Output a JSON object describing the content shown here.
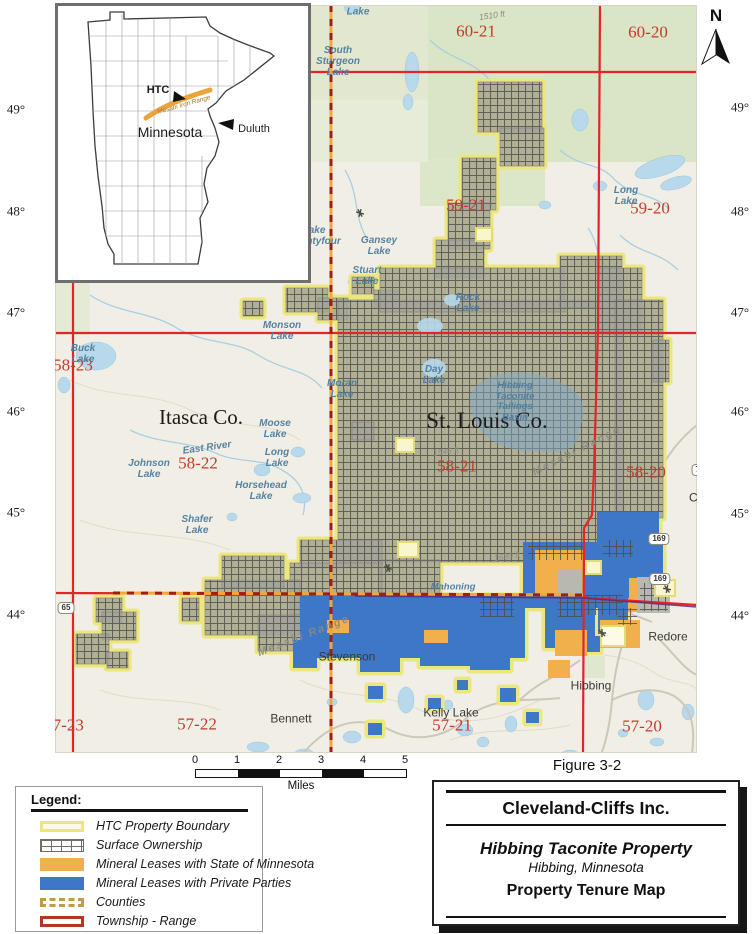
{
  "figure_label": "Figure 3-2",
  "title_block": {
    "company": "Cleveland-Cliffs Inc.",
    "property": "Hibbing Taconite Property",
    "location": "Hibbing, Minnesota",
    "map_title": "Property Tenure Map"
  },
  "legend": {
    "header": "Legend:",
    "items": [
      {
        "label": "HTC Property Boundary",
        "type": "boundary"
      },
      {
        "label": "Surface Ownership",
        "type": "surface"
      },
      {
        "label": "Mineral Leases with State of Minnesota",
        "type": "state-lease"
      },
      {
        "label": "Mineral Leases with Private Parties",
        "type": "private-lease"
      },
      {
        "label": "Counties",
        "type": "counties"
      },
      {
        "label": "Township - Range",
        "type": "township-range"
      }
    ]
  },
  "scale_bar": {
    "ticks": [
      "0",
      "1",
      "2",
      "3",
      "4",
      "5"
    ],
    "unit": "Miles"
  },
  "north_arrow": {
    "label": "N"
  },
  "inset": {
    "htc": "HTC",
    "range": "Mesabi Iron Range",
    "state": "Minnesota",
    "city": "Duluth"
  },
  "map": {
    "colors": {
      "property_boundary": "#ece67f",
      "surface_ownership": "#a3a29a",
      "state_lease": "#f0b14d",
      "private_lease": "#3d77c5",
      "township_line": "#e3242b",
      "county_line": "#f2a63a",
      "water": "#b7d9eb"
    },
    "townships": [
      {
        "text": "60-21",
        "x": 476,
        "y": 31
      },
      {
        "text": "60-20",
        "x": 648,
        "y": 32
      },
      {
        "text": "59-21",
        "x": 466,
        "y": 205
      },
      {
        "text": "59-20",
        "x": 650,
        "y": 208
      },
      {
        "text": "58-23",
        "x": 73,
        "y": 365
      },
      {
        "text": "58-22",
        "x": 198,
        "y": 463
      },
      {
        "text": "58-21",
        "x": 457,
        "y": 466
      },
      {
        "text": "58-20",
        "x": 646,
        "y": 472
      },
      {
        "text": "57-23",
        "x": 64,
        "y": 725
      },
      {
        "text": "57-22",
        "x": 197,
        "y": 724
      },
      {
        "text": "57-21",
        "x": 452,
        "y": 725
      },
      {
        "text": "57-20",
        "x": 642,
        "y": 726
      }
    ],
    "degrees_left": [
      {
        "text": "49°",
        "y": 110
      },
      {
        "text": "48°",
        "y": 212
      },
      {
        "text": "47°",
        "y": 313
      },
      {
        "text": "46°",
        "y": 412
      },
      {
        "text": "45°",
        "y": 513
      },
      {
        "text": "44°",
        "y": 615
      }
    ],
    "degrees_right": [
      {
        "text": "49°",
        "y": 108
      },
      {
        "text": "48°",
        "y": 212
      },
      {
        "text": "47°",
        "y": 313
      },
      {
        "text": "46°",
        "y": 412
      },
      {
        "text": "45°",
        "y": 514
      },
      {
        "text": "44°",
        "y": 616
      }
    ],
    "counties": [
      {
        "text": "Itasca Co.",
        "x": 201,
        "y": 418,
        "fs": 21
      },
      {
        "text": "St. Louis Co.",
        "x": 487,
        "y": 421,
        "fs": 23
      }
    ],
    "lakes": [
      {
        "text": "Lake",
        "x": 358,
        "y": 12
      },
      {
        "text": "South\nSturgeon\nLake",
        "x": 338,
        "y": 62
      },
      {
        "text": "Long\nLake",
        "x": 626,
        "y": 196
      },
      {
        "text": "Lake\nTwentyfour",
        "x": 314,
        "y": 236
      },
      {
        "text": "Gansey\nLake",
        "x": 379,
        "y": 246
      },
      {
        "text": "Stuart\nLake",
        "x": 367,
        "y": 276
      },
      {
        "text": "Monson\nLake",
        "x": 282,
        "y": 331
      },
      {
        "text": "Buck\nLake",
        "x": 83,
        "y": 354
      },
      {
        "text": "Moran\nLake",
        "x": 342,
        "y": 389
      },
      {
        "text": "Rock\nLake",
        "x": 468,
        "y": 303
      },
      {
        "text": "Day\nLake",
        "x": 434,
        "y": 375
      },
      {
        "text": "Moose\nLake",
        "x": 275,
        "y": 429
      },
      {
        "text": "Long\nLake",
        "x": 277,
        "y": 458
      },
      {
        "text": "Johnson\nLake",
        "x": 149,
        "y": 469
      },
      {
        "text": "Horsehead\nLake",
        "x": 261,
        "y": 491
      },
      {
        "text": "Shafer\nLake",
        "x": 197,
        "y": 525
      },
      {
        "text": "East River",
        "x": 207,
        "y": 448,
        "rot": -8
      },
      {
        "text": "Hibbing\nTaconite\nTailings\nBasin",
        "x": 515,
        "y": 402,
        "fs": 9.5
      },
      {
        "text": "Mahoning",
        "x": 453,
        "y": 588,
        "fs": 9.5
      }
    ],
    "towns": [
      {
        "text": "Stevenson",
        "x": 347,
        "y": 657
      },
      {
        "text": "Bennett",
        "x": 291,
        "y": 719
      },
      {
        "text": "Hibbing",
        "x": 591,
        "y": 686
      },
      {
        "text": "Redore",
        "x": 668,
        "y": 637
      },
      {
        "text": "Kelly Lake",
        "x": 451,
        "y": 713
      },
      {
        "text": "Chisholm",
        "x": 714,
        "y": 498
      }
    ],
    "ranges": [
      {
        "text": "Mesabi Range",
        "x": 577,
        "y": 451,
        "rot": -27
      },
      {
        "text": "Mesabi Range",
        "x": 304,
        "y": 636,
        "rot": -21
      }
    ],
    "elevations": [
      {
        "text": "1510 ft",
        "x": 492,
        "y": 16,
        "rot": -8
      },
      {
        "text": "1546 ft",
        "x": 446,
        "y": 452,
        "rot": -8
      },
      {
        "text": "1680 ft",
        "x": 507,
        "y": 557,
        "rot": -8
      }
    ],
    "highway_shields": [
      {
        "text": "65",
        "x": 66,
        "y": 608
      },
      {
        "text": "169",
        "x": 659,
        "y": 539
      },
      {
        "text": "169",
        "x": 660,
        "y": 579
      },
      {
        "text": "73",
        "x": 700,
        "y": 470
      }
    ]
  }
}
